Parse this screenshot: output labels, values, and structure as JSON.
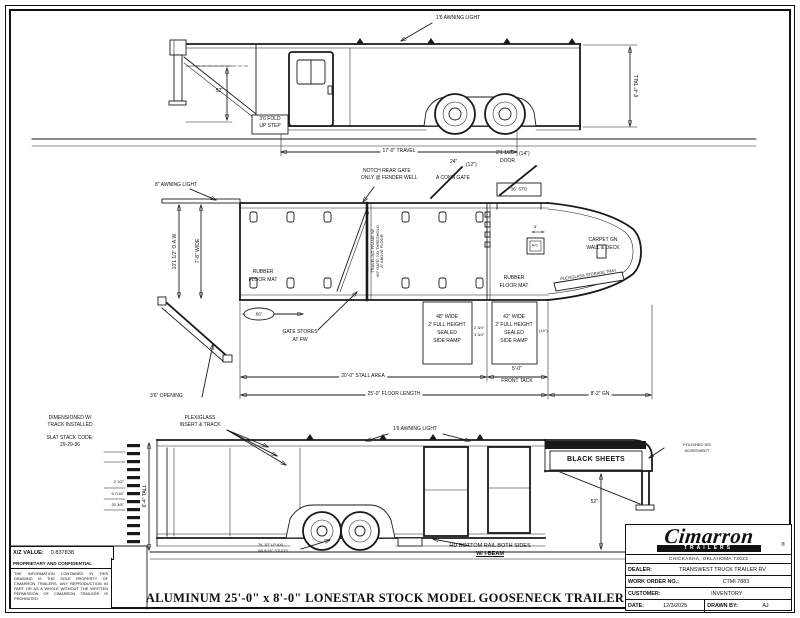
{
  "colors": {
    "ink": "#1a1a1a",
    "paper": "#ffffff"
  },
  "drawing_title": "ALUMINUM 25'-0\" x 8'-0\" LONESTAR STOCK MODEL GOOSENECK TRAILER",
  "top_view": {
    "awning_light": "1'6 AWNING LIGHT",
    "height_dim": "6'-4\" TALL",
    "neck_height_dim": "52\"",
    "step_line1": "3'6 FOLD",
    "step_line2": "UP STEP",
    "travel_dim": "17'-0\" TRAVEL"
  },
  "plan_view": {
    "awning_light": "8\" AWNING LIGHT",
    "oaw_dim": "10'1 1/2\" O.A.W.",
    "width_dim": "7'-8\" WIDE",
    "notch_line1": "NOTCH REAR GATE",
    "notch_line2": "ONLY @ FENDER WELL",
    "conn_gate_dim": "24\"",
    "conn_gate_offset": "(12\")",
    "conn_gate_label": "A CONN GATE",
    "door_dim": "2'1 1/2\"",
    "door_offset": "(14\")",
    "door_label": "DOOR",
    "door_header": "36\" STD",
    "carpet_line1": "CARPET GN",
    "carpet_line2": "WALL & DECK",
    "ac_label": "A/C",
    "ac_dim": "5\"",
    "mat_rear_line1": "RUBBER",
    "mat_rear_line2": "FLOOR MAT",
    "mat_front_line1": "RUBBER",
    "mat_front_line2": "FLOOR MAT",
    "gate_note_line1": "TRAVELING FRAME W/",
    "gate_note_line2": "60\" GATE, NO THRESHOLD",
    "gate_note_line3": "8\" ABOVE FLOOR",
    "bay_dim": "66\"",
    "gate_stores_line1": "GATE STORES",
    "gate_stores_line2": "AT FW",
    "ramp48_line1": "48\" WIDE",
    "ramp48_line2": "2' FULL HEIGHT",
    "ramp48_line3": "SEALED",
    "ramp48_line4": "SIDE RAMP",
    "ramp42_line1": "42\" WIDE",
    "ramp42_line2": "2' FULL HEIGHT",
    "ramp42_line3": "SEALED",
    "ramp42_line4": "SIDE RAMP",
    "ramp_gap_dim1": "2 3/4\"",
    "ramp_gap_dim2": "3 3/4\"",
    "ramp42_offset": "(14\")",
    "storage_line1": "PLEXIGLASS",
    "storage_line2": "STORAGE TRAY",
    "opening_dim": "3'6\" OPENING",
    "stall_dim": "20'-0\" STALL AREA",
    "floor_dim": "25'-0\" FLOOR LENGTH",
    "front_tack_dim1": "5'-0\"",
    "front_tack_dim2": "FRONT TACK",
    "gooseneck_dim": "8'-2\" GN"
  },
  "bottom_view": {
    "note_line1": "DIMENSIONED W/",
    "note_line2": "TRACK INSTALLED",
    "slat_code_label": "SLAT STACK CODE:",
    "slat_code": "29-29-36",
    "plexi_line1": "PLEXIGLASS",
    "plexi_line2": "INSERT & TRACK",
    "awning_light": "1'6 AWNING LIGHT",
    "black_sheets": "BLACK SHEETS",
    "nose_line1": "POLISHED S/S",
    "nose_line2": "NOSESHEET",
    "neck_height_dim": "52\"",
    "height_dim": "6'-4\" TALL",
    "stack_dim1": "2 1/2\"",
    "stack_dim2": "9 7/16\"",
    "stack_dim3": "20 3/8\"",
    "axle_line1": "7K 10\" LP AXL.",
    "axle_line2": "W/ 9/16\" STUDS",
    "rail_line1": "HD BOTTOM RAIL BOTH SIDES",
    "rail_line2": "W/ I-BEAM"
  },
  "info_block": {
    "xz_label": "X/Z VALUE:",
    "xz_value": "0.837838",
    "proprietary_title": "PROPRIETARY AND CONFIDENTIAL",
    "legal_text": "THE INFORMATION CONTAINED IN THIS DRAWING IS THE SOLE PROPERTY OF CIMARRON TRAILERS. ANY REPRODUCTION IN PART OR AS A WHOLE WITHOUT THE WRITTEN PERMISSION OF CIMARRON TRAILERS IS PROHIBITED."
  },
  "title_block": {
    "brand": "Cimarron",
    "brand_sub": "TRAILERS",
    "brand_reg": "®",
    "address": "CHICKASHA, OKLAHOMA 73023",
    "dealer_label": "DEALER:",
    "dealer_value": "TRANSWEST TRUCK TRAILER RV",
    "wo_label": "WORK ORDER NO.:",
    "wo_value": "CTMI 7883",
    "customer_label": "CUSTOMER:",
    "customer_value": "INVENTORY",
    "date_label": "DATE:",
    "date_value": "12/3/2025",
    "drawn_label": "DRAWN BY:",
    "drawn_value": "AJ"
  }
}
